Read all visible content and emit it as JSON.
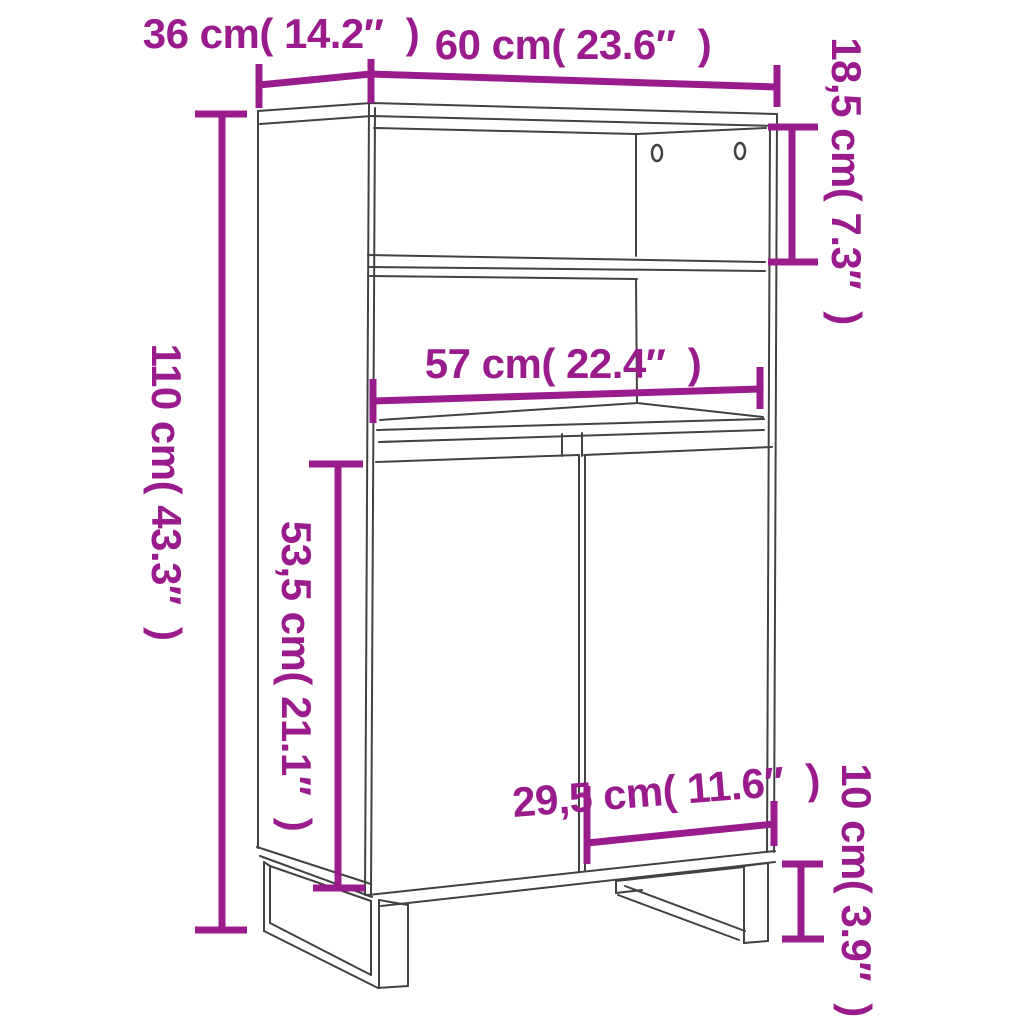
{
  "diagram": {
    "title": "highboard-dimension-diagram",
    "accent_color": "#9A1C8C",
    "line_color": "#424242",
    "dimensions": {
      "depth": {
        "label": "36 cm( 14.2″  )",
        "cm": 36,
        "inches": 14.2
      },
      "width": {
        "label": "60 cm( 23.6″  )",
        "cm": 60,
        "inches": 23.6
      },
      "top_section": {
        "label": "18,5 cm( 7.3″  )",
        "cm": 18.5,
        "inches": 7.3
      },
      "total_height": {
        "label": "110 cm( 43.3″  )",
        "cm": 110,
        "inches": 43.3
      },
      "inner_width": {
        "label": "57 cm( 22.4″  )",
        "cm": 57,
        "inches": 22.4
      },
      "door_height": {
        "label": "53,5 cm( 21.1″  )",
        "cm": 53.5,
        "inches": 21.1
      },
      "door_width": {
        "label": "29,5 cm( 11.6″  )",
        "cm": 29.5,
        "inches": 11.6
      },
      "leg_height": {
        "label": "10 cm( 3.9″  )",
        "cm": 10,
        "inches": 3.9
      }
    }
  }
}
